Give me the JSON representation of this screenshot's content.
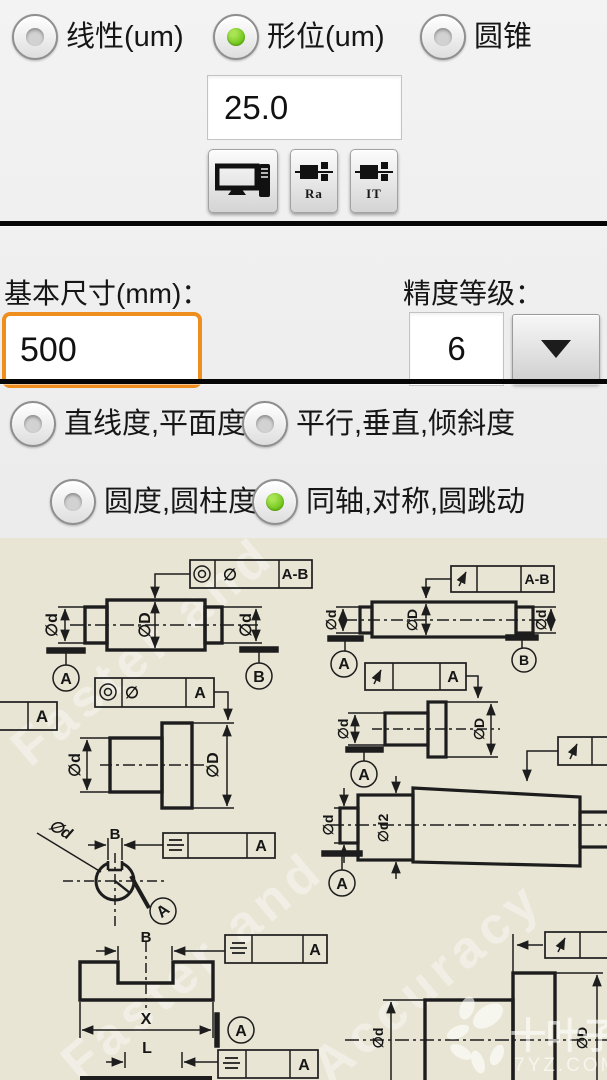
{
  "app": {
    "bg": "#e9e9e9",
    "drawing_bg": "#e8e5d4",
    "accent_orange": "#ee8e1e",
    "radio_green": "#6dc417"
  },
  "mode_row": {
    "options": [
      {
        "label": "线性(um)",
        "selected": false
      },
      {
        "label": "形位(um)",
        "selected": true
      },
      {
        "label": "圆锥",
        "selected": false
      }
    ]
  },
  "tolerance_input": {
    "value": "25.0"
  },
  "toolbar": {
    "ra_label": "Ra",
    "it_label": "IT"
  },
  "basic_size": {
    "label": "基本尺寸(mm)：",
    "value": "500"
  },
  "precision": {
    "label": "精度等级：",
    "value": "6"
  },
  "form_options": [
    {
      "label": "直线度,平面度",
      "selected": false
    },
    {
      "label": "平行,垂直,倾斜度",
      "selected": false
    },
    {
      "label": "圆度,圆柱度",
      "selected": false
    },
    {
      "label": "同轴,对称,圆跳动",
      "selected": true
    }
  ],
  "drawing": {
    "phi": "∅",
    "phi_d": "∅d",
    "phi_D": "∅D",
    "phi_d2": "∅d2",
    "datum_a": "A",
    "datum_b": "B",
    "datum_ab": "A-B",
    "dim_b": "B",
    "dim_x": "X",
    "dim_l": "L",
    "watermark_line1": "Faster and",
    "watermark_line2": "Accuracy",
    "brand": "十叶子",
    "site": "7YZ.COM"
  }
}
